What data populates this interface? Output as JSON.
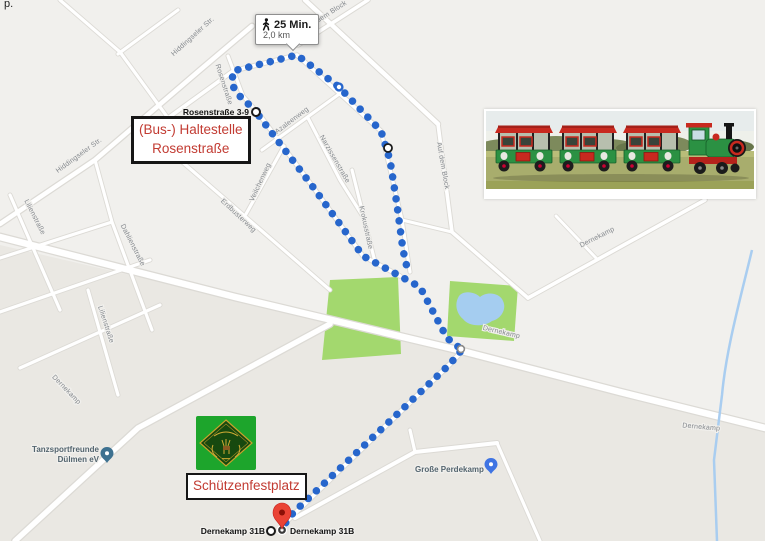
{
  "page": {
    "stray_text": "p."
  },
  "map": {
    "route_summary": {
      "duration": "25 Min.",
      "distance": "2,0 km",
      "icon": "walking-person-icon"
    },
    "markers": {
      "origin_label": "Rosenstraße 3-9",
      "destination_label": "Dernekamp 31B",
      "destination_label_2": "Dernekamp 31B"
    },
    "callouts": {
      "bus_stop_line1": "(Bus-) Haltestelle",
      "bus_stop_line2": "Rosenstraße",
      "festplatz": "Schützenfestplatz"
    },
    "pois": {
      "tanzsport_line1": "Tanzsportfreunde",
      "tanzsport_line2": "Dülmen eV",
      "perdekamp": "Große Perdekamp"
    },
    "streets": {
      "hiddingseler": "Hiddingseler Str.",
      "auf_dem_block": "Auf dem Block",
      "azaleenweg": "Azaleenweg",
      "narzissenstrasse": "Narzissenstraße",
      "veilchenweg": "Veilchenweg",
      "erdbusterweg": "Erdbusterweg",
      "krokusstrasse": "Krokusstraße",
      "rosenstrasse": "Rosenstraße",
      "lilienstrasse": "Lilienstraße",
      "dahlienstrasse": "Dahlienstraße",
      "dernekamp": "Dernekamp"
    },
    "colors": {
      "route_blue": "#2766cc",
      "callout_red": "#c23b32",
      "park_green": "#a3d86e",
      "water_blue": "#a5cdf0",
      "destination_pin": "#ea4335",
      "poi_pin_blue": "#3f74e3",
      "poi_pin_teal": "#3e7190"
    }
  },
  "photo": {
    "description": "green-and-red tourist road train with locomotive and three covered wagons on a meadow"
  },
  "emblem": {
    "description": "green club emblem: dark green diamond with gold stag and laurel"
  }
}
